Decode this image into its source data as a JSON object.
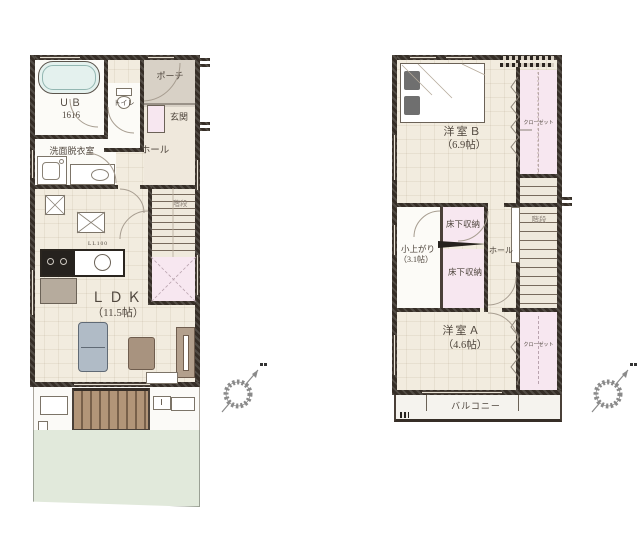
{
  "floor1": {
    "porch": "ポーチ",
    "entrance": "玄関",
    "bath_line1": "ＵＢ",
    "bath_line2": "1616",
    "toilet": "トイレ",
    "washroom": "洗面脱衣室",
    "hall": "ホール",
    "stairs": "階段",
    "kitchen_note": "LL100",
    "ldk": "ＬＤＫ",
    "ldk_size": "（11.5帖）"
  },
  "floor2": {
    "bedroom_b": "洋室Ｂ",
    "bedroom_b_size": "（6.9帖）",
    "closet_b": "クローゼット",
    "underfloor_top": "床下収納",
    "koagari": "小上がり",
    "koagari_size": "（3.1帖）",
    "underfloor_bottom": "床下収納",
    "hall": "ホール",
    "stairs": "階段",
    "bedroom_a": "洋室Ａ",
    "bedroom_a_size": "（4.6帖）",
    "closet_a": "クローゼット",
    "balcony": "バルコニー"
  },
  "colors": {
    "wall": "#362e27",
    "floor": "#f2ecdf",
    "closet_pink": "#f7e7f0",
    "porch_gray": "#d8d1c6",
    "garden_green": "#e1e9db",
    "deck_brown": "#b29578",
    "bathtub_cyan": "#e4f1ee",
    "sofa_blue": "#b0bbc6"
  }
}
